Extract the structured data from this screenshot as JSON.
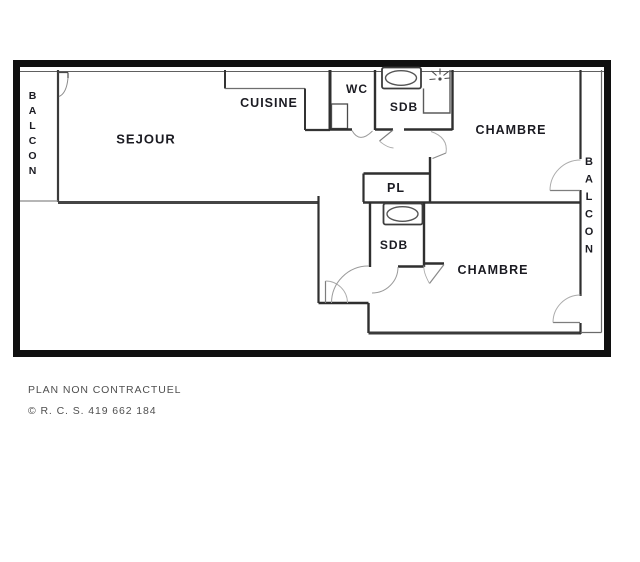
{
  "plan": {
    "title": "apartment-floor-plan",
    "rooms": {
      "balcon_left": "BALCON",
      "sejour": "SEJOUR",
      "cuisine": "CUISINE",
      "wc": "WC",
      "sdb_top": "SDB",
      "chambre_top": "CHAMBRE",
      "pl": "PL",
      "sdb_bottom": "SDB",
      "chambre_bottom": "CHAMBRE",
      "balcon_right": "BALCON"
    },
    "fixtures": [
      "bathtub-top",
      "shower-spray",
      "bathtub-bottom"
    ],
    "colors": {
      "frame": "#101010",
      "wall": "#2f2f2f",
      "thin_line": "#8a8a8a",
      "door_arc": "#ababab",
      "label": "#1b1b22",
      "footer_text": "#4f4f4f",
      "background": "#ffffff"
    }
  },
  "footer": {
    "disclaimer": "PLAN NON CONTRACTUEL",
    "registration": "© R. C. S. 419 662 184"
  }
}
